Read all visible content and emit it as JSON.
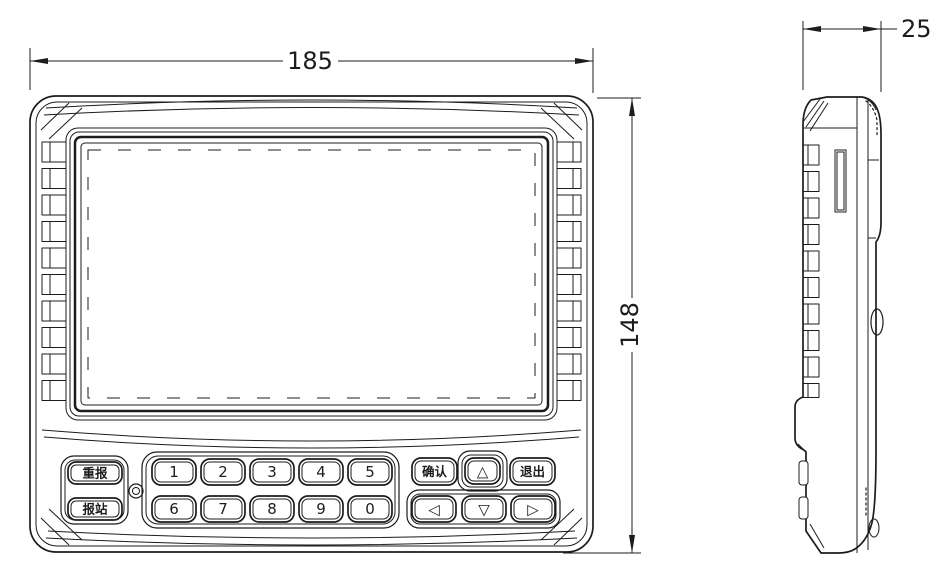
{
  "dimensions": {
    "width": "185",
    "height": "148",
    "depth": "25"
  },
  "keypad": {
    "replay_label": "重报",
    "announce_label": "报站",
    "digits_row1": [
      "1",
      "2",
      "3",
      "4",
      "5"
    ],
    "digits_row2": [
      "6",
      "7",
      "8",
      "9",
      "0"
    ],
    "confirm_label": "确认",
    "exit_label": "退出",
    "arrow_up": "△",
    "arrow_down": "▽",
    "arrow_left": "◁",
    "arrow_right": "▷"
  },
  "colors": {
    "line": "#1c1c1c",
    "background": "#ffffff"
  }
}
